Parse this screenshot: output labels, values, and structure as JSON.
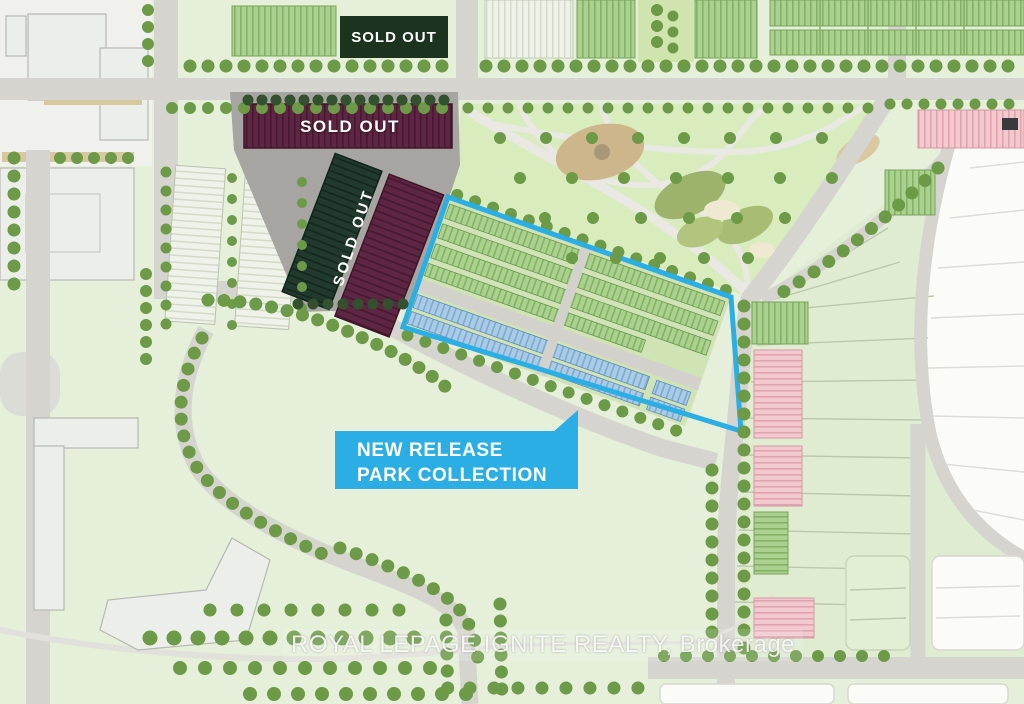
{
  "map": {
    "watermark": "ROYAL LEPAGE IGNITE REALTY, Brokerage",
    "labels": {
      "sold_out_top": "SOLD OUT",
      "sold_out_mid": "SOLD OUT",
      "sold_out_vertical": "SOLD OUT"
    },
    "callout": {
      "line1": "NEW RELEASE",
      "line2": "PARK COLLECTION"
    },
    "colors": {
      "highlight_cyan": "#2aaee4",
      "sold_out_dark_green": "#1b331f",
      "sold_out_maroon": "#5e2642",
      "new_release_blue_units": "#a9cbe5",
      "available_green_units": "#abd18e",
      "future_pink_units": "#f2c9cf",
      "park_green": "#d9ecbe",
      "road_gray": "#d5d4cf",
      "tree_green": "#6d9a46",
      "background_green": "#e5efd9"
    }
  }
}
